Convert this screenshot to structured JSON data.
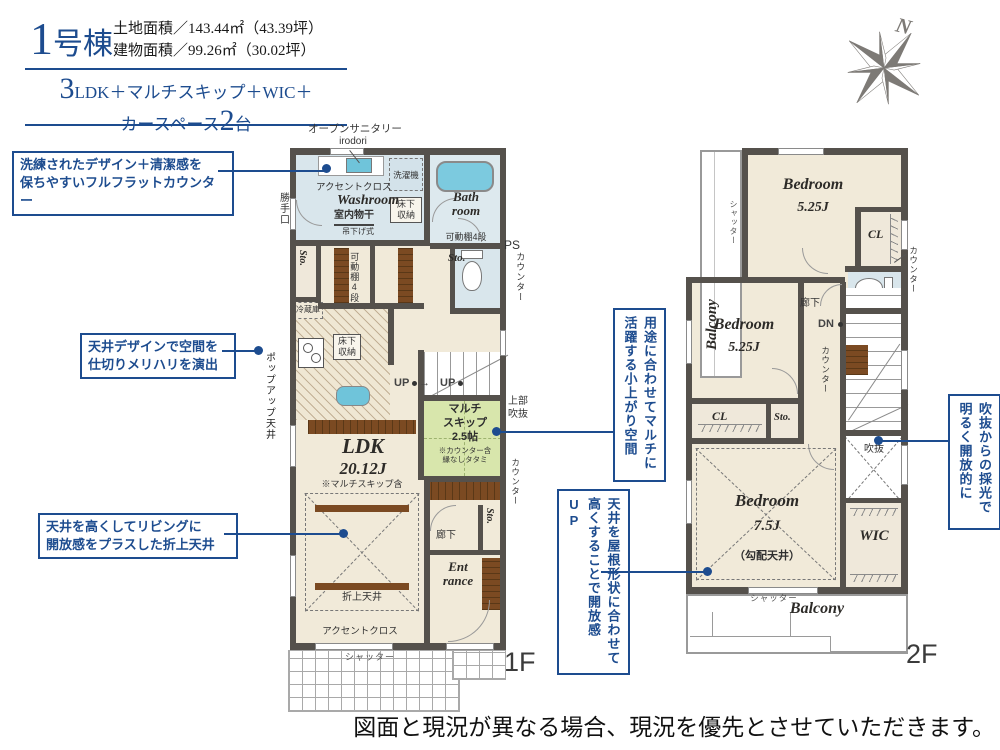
{
  "header": {
    "unit_number": "1",
    "unit_suffix": "号棟",
    "land_area": "土地面積／143.44㎡（43.39坪）",
    "building_area": "建物面積／99.26㎡（30.02坪）",
    "plan_big": "3",
    "plan_rest": "LDK＋マルチスキップ＋WIC＋",
    "plan2_pre": "カースペース",
    "plan2_big": "2",
    "plan2_post": "台"
  },
  "callouts": {
    "flat_counter": "洗練されたデザイン＋清潔感を\n保ちやすいフルフラットカウンター",
    "ceiling_design": "天井デザインで空間を\n仕切りメリハリを演出",
    "folded_ceiling": "天井を高くしてリビングに\n開放感をプラスした折上天井",
    "multi_space": "用途に合わせてマルチに活躍する小上がり空間",
    "roof_ceiling": "天井を屋根形状に合わせて高くすることで開放感UP",
    "void_light": "吹抜からの採光で明るく開放的に"
  },
  "compass": {
    "north": "N"
  },
  "floor1": {
    "open_sanitary": "オープンサニタリー",
    "open_sanitary_sub": "irodori",
    "accent_cross_top": "アクセントクロス",
    "washroom": "Washroom",
    "indoor_drying": "室内物干",
    "hanging_type": "吊下げ式",
    "washer": "洗濯機",
    "bathroom": "Bath\nroom",
    "bath_shelf": "可動棚4段",
    "ps": "PS",
    "counter_right": "カウンター",
    "kitchen_door": "勝手口",
    "sto1": "Sto.",
    "shelf_v": "可動棚4段",
    "sto2": "Sto.",
    "underfloor1": "床下\n収納",
    "fridge": "冷蔵庫",
    "underfloor2": "床下\n収納",
    "popup_ceiling": "ポップアップ天井",
    "up1": "UP",
    "up_arrow": "→",
    "up2": "UP",
    "multi_skip": "マルチ\nスキップ\n2.5帖",
    "multi_note": "※カウンター含\n縁なしタタミ",
    "upper_void": "上部\n吹抜",
    "counter_mid": "カウンター",
    "ldk": "LDK",
    "ldk_size": "20.12J",
    "ldk_note": "※マルチスキップ含",
    "folded_label": "折上天井",
    "accent_cross_bottom": "アクセントクロス",
    "hallway": "廊下",
    "sto3": "Sto.",
    "entrance": "Ent\nrance",
    "shutter": "シャッター",
    "floor_label": "1F"
  },
  "floor2": {
    "balcony_top": "Balcony",
    "shutter_top": "シャッター",
    "bedroom1": "Bedroom",
    "bedroom1_size": "5.25J",
    "cl1": "CL",
    "counter1": "カウンター",
    "bedroom2": "Bedroom",
    "bedroom2_size": "5.25J",
    "hallway": "廊下",
    "dn": "DN",
    "counter2": "カウンター",
    "cl2": "CL",
    "sto": "Sto.",
    "void": "吹抜",
    "bedroom3": "Bedroom",
    "bedroom3_size": "7.5J",
    "sloped_ceiling": "（勾配天井）",
    "wic": "WIC",
    "shutter_bottom": "シャッター",
    "balcony_bottom": "Balcony",
    "floor_label": "2F"
  },
  "footer": {
    "disclaimer": "図面と現況が異なる場合、現況を優先とさせていただきます。"
  }
}
